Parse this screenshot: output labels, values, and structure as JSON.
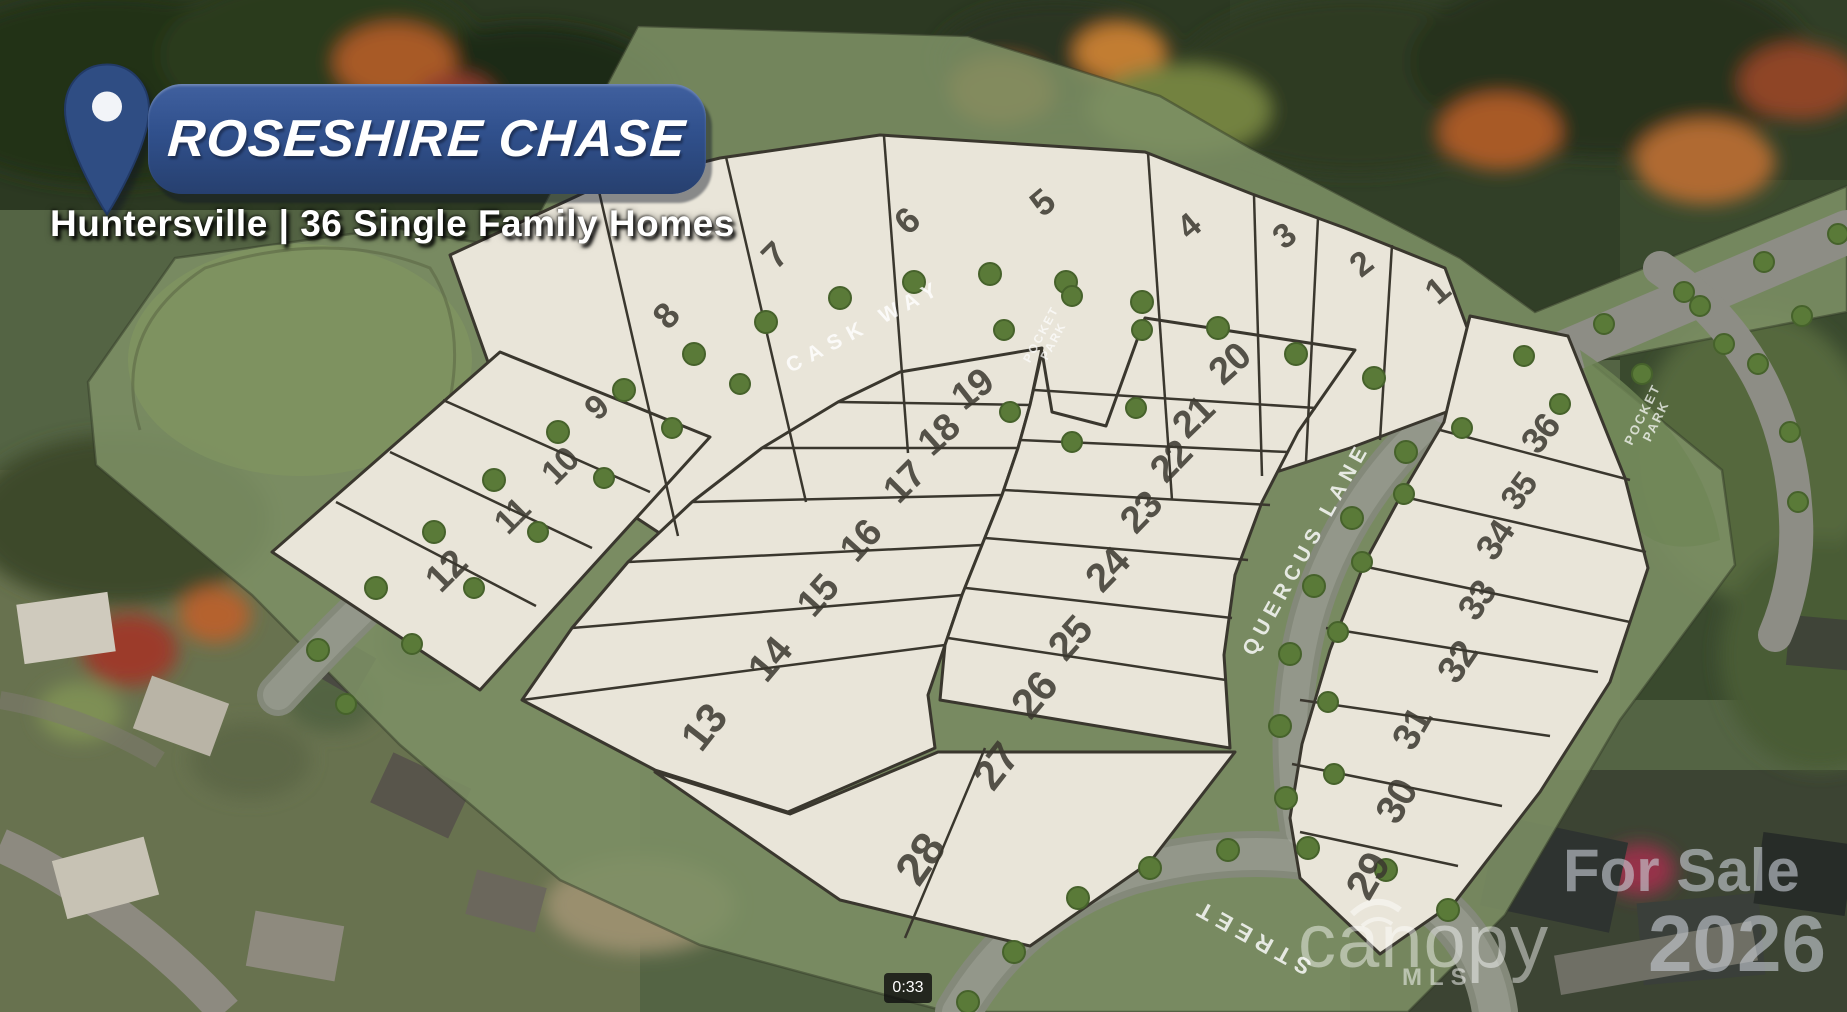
{
  "header": {
    "community_name": "ROSESHIRE CHASE",
    "subtitle": "Huntersville | 36 Single Family Homes"
  },
  "site_plan": {
    "streets": [
      {
        "name": "CASK WAY"
      },
      {
        "name": "QUERCUS LANE"
      },
      {
        "name": "STREET"
      }
    ],
    "pocket_park": {
      "line1": "POCKET",
      "line2": "PARK"
    },
    "lots": [
      "1",
      "2",
      "3",
      "4",
      "5",
      "6",
      "7",
      "8",
      "9",
      "10",
      "11",
      "12",
      "13",
      "14",
      "15",
      "16",
      "17",
      "18",
      "19",
      "20",
      "21",
      "22",
      "23",
      "24",
      "25",
      "26",
      "27",
      "28",
      "29",
      "30",
      "31",
      "32",
      "33",
      "34",
      "35",
      "36"
    ]
  },
  "watermarks": {
    "for_sale": "For Sale",
    "year": "2026",
    "mls_brand": "canopy",
    "mls_sub": "MLS"
  },
  "video": {
    "timestamp": "0:33"
  },
  "colors": {
    "banner_blue": "#30508c",
    "pin_blue": "#2f4d83",
    "parcel_fill": "#e9e5d9",
    "overlay_green": "#7d9065",
    "road_gray": "#84897a",
    "lot_number": "#3b382f",
    "watermark_gray": "#c6ccd3"
  }
}
